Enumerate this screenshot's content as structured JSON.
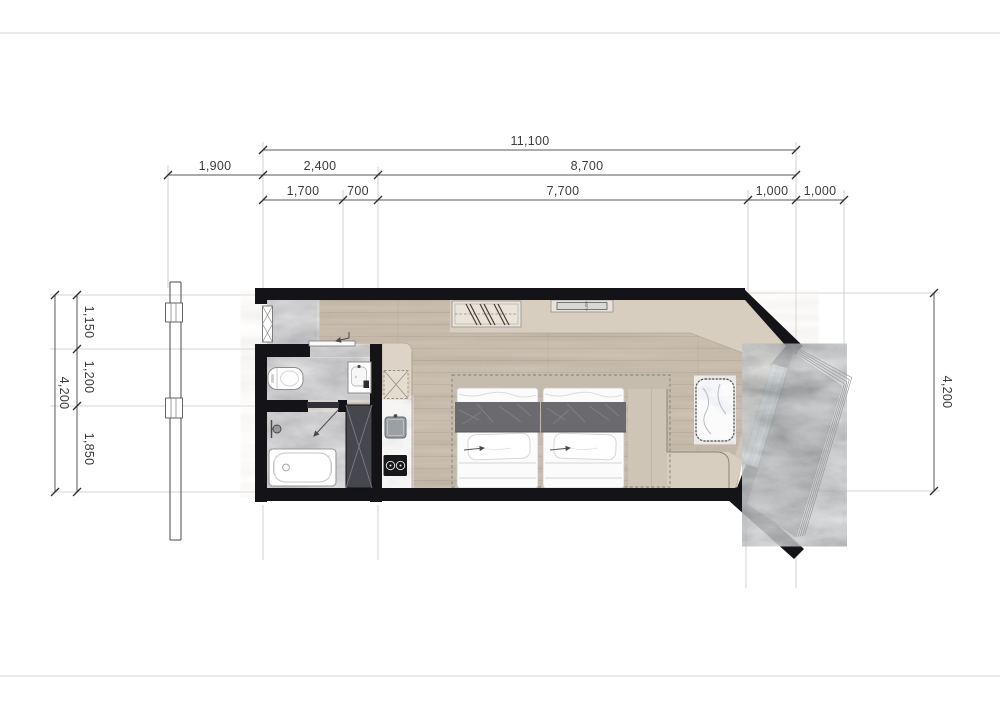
{
  "drawing": {
    "type": "studio apartment floor plan",
    "dimensions": {
      "top": {
        "total": "11,100",
        "row2": [
          "1,900",
          "2,400",
          "8,700"
        ],
        "row3": [
          "1,700",
          "700",
          "7,700",
          "1,000",
          "1,000"
        ]
      },
      "left": {
        "total": "4,200",
        "segments": [
          "1,150",
          "1,200",
          "1,850"
        ]
      },
      "right": {
        "total": "4,200"
      }
    },
    "labels": {
      "tv": "55TV"
    },
    "colors": {
      "wall": "#131318",
      "wood_floor": "#b7a896",
      "accent_floor": "#d8cec0",
      "bath_marble": "#9d9d9d",
      "balcony_stone": "#5f6163",
      "glass": "#c5dade",
      "wardrobe": "#46464d",
      "bed_blanket": "#6a6a6f"
    }
  }
}
